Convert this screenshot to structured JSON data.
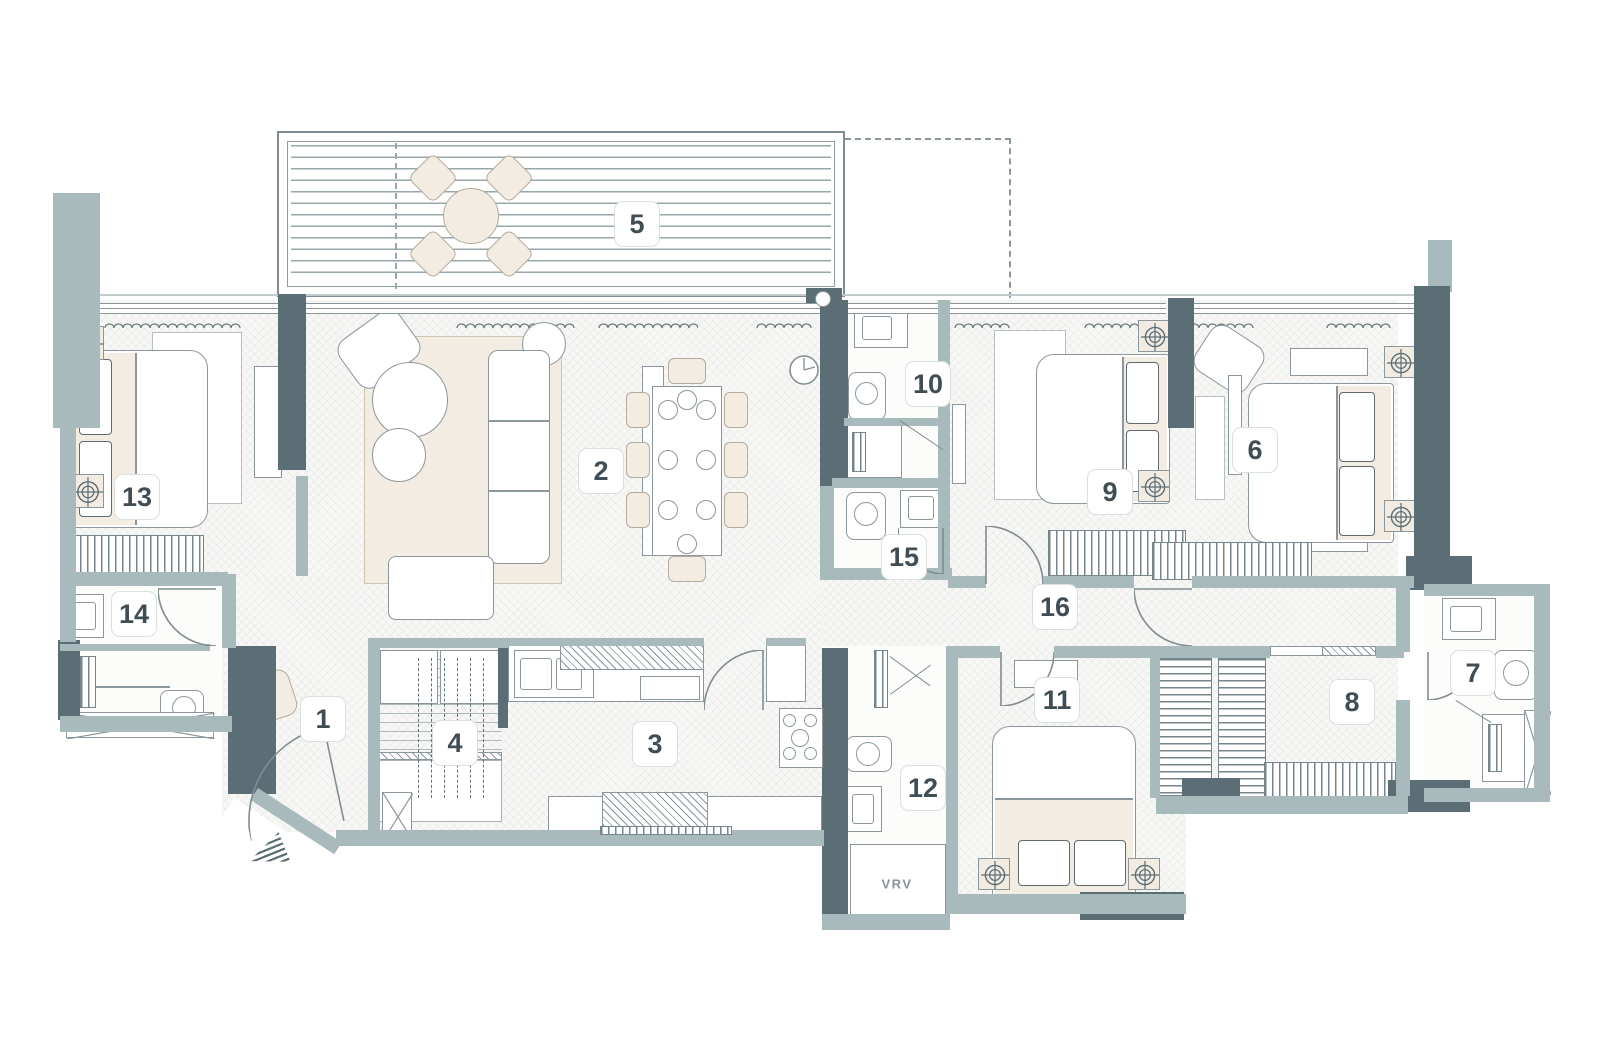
{
  "title": "apartment-floor-plan",
  "palette": {
    "wall_dark": "#5b6d75",
    "wall_light": "#a9babc",
    "outline": "#8b979c",
    "floor": "#f7f7f5",
    "furniture_cream": "#f3ece2",
    "label_text": "#414d55",
    "label_border": "#dadfe0"
  },
  "texts": {
    "vrv": "VRV"
  },
  "room_labels": [
    {
      "id": "1",
      "label": "1"
    },
    {
      "id": "2",
      "label": "2"
    },
    {
      "id": "3",
      "label": "3"
    },
    {
      "id": "4",
      "label": "4"
    },
    {
      "id": "5",
      "label": "5"
    },
    {
      "id": "6",
      "label": "6"
    },
    {
      "id": "7",
      "label": "7"
    },
    {
      "id": "8",
      "label": "8"
    },
    {
      "id": "9",
      "label": "9"
    },
    {
      "id": "10",
      "label": "10"
    },
    {
      "id": "11",
      "label": "11"
    },
    {
      "id": "12",
      "label": "12"
    },
    {
      "id": "13",
      "label": "13"
    },
    {
      "id": "14",
      "label": "14"
    },
    {
      "id": "15",
      "label": "15"
    },
    {
      "id": "16",
      "label": "16"
    }
  ],
  "icons": {
    "spot": "ceiling-spot-light-icon",
    "entry_arrow": "entrance-arrow-icon",
    "clock": "wall-clock-icon",
    "door": "door-swing-icon",
    "shaft": "shaft-cross-icon",
    "curtain": "curtain-squiggle-icon"
  }
}
